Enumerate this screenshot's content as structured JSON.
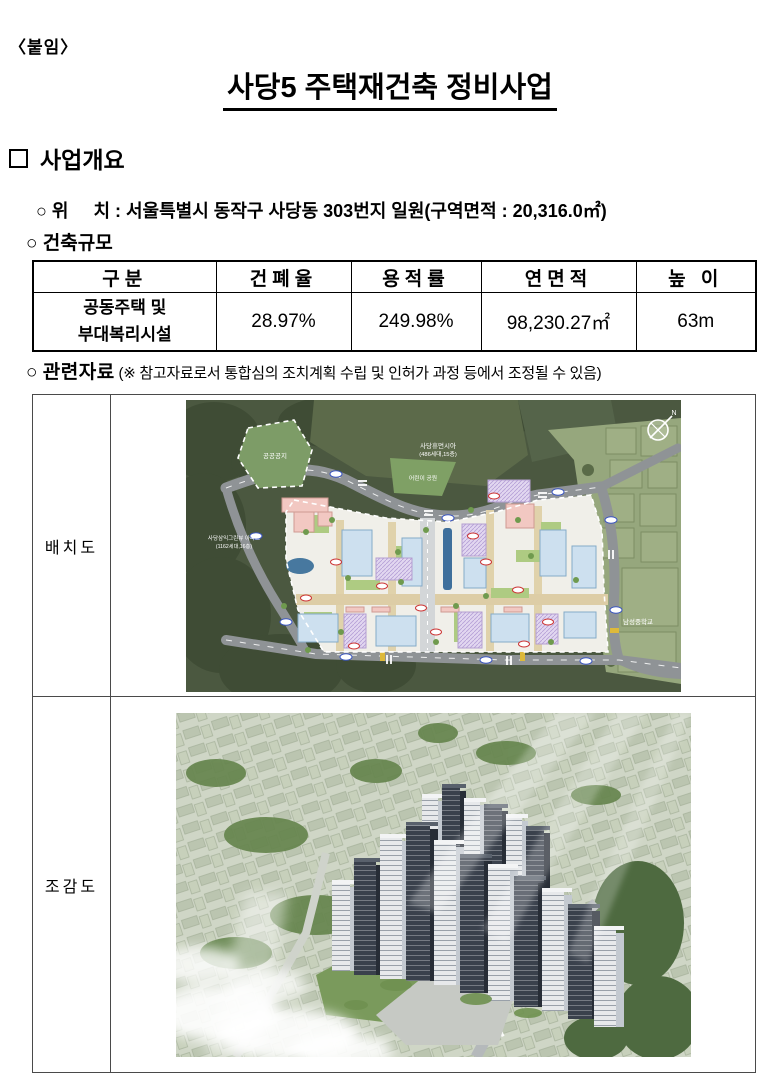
{
  "doc": {
    "attachment": "〈붙임〉",
    "title": "사당5 주택재건축 정비사업"
  },
  "overview": {
    "heading": "사업개요",
    "location_line": "○ 위     치 : 서울특별시 동작구 사당동 303번지 일원(구역면적 : 20,316.0㎡)",
    "scale_line": "○ 건축규모",
    "table": {
      "headers": [
        "구분",
        "건폐율",
        "용적률",
        "연면적",
        "높 이"
      ],
      "row": {
        "category": [
          "공동주택 및",
          "부대복리시설"
        ],
        "building_coverage": "28.97%",
        "floor_area_ratio": "249.98%",
        "gross_floor_area": "98,230.27㎡",
        "height": "63m"
      }
    }
  },
  "related": {
    "bullet": "○ ",
    "heading": "관련자료",
    "note": " (※ 참고자료로서 통합심의 조치계획 수립 및 인허가 과정 등에서 조정될 수 있음)"
  },
  "figures": {
    "site_plan_label": "배치도",
    "birds_eye_label": "조감도",
    "site_plan": {
      "public_space": "공공공지",
      "north_apartment": "사당휴먼시아",
      "north_apartment_detail": "(486세대,15층)",
      "children_park": "어린이 공원",
      "west_apartment": "사당삼익그린뷰 아파트",
      "west_apartment_detail": "(1162세대,16층)",
      "school": "남성중학교",
      "compass": "N"
    }
  },
  "colors": {
    "forest_green": "#4b5840",
    "field_sage": "#96a77d",
    "road_gray": "#8f9396",
    "building_pink": "#f2c8c2",
    "building_blue": "#cde0ef",
    "building_lavender": "#e2d7f0",
    "label_red": "#cc3333",
    "label_blue": "#3a55c0"
  }
}
